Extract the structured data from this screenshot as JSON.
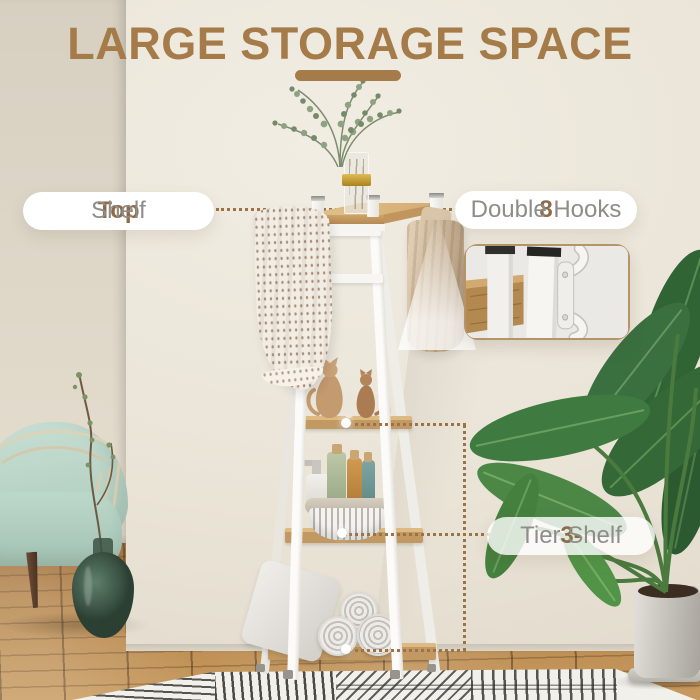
{
  "title": {
    "text": "LARGE STORAGE SPACE"
  },
  "callouts": {
    "top_shelf": {
      "bold": "Top",
      "rest": " Shelf"
    },
    "double_hooks": {
      "bold": "8",
      "rest": " Double Hooks"
    },
    "tier_shelf": {
      "bold": "3-",
      "rest": "Tier Shelf"
    }
  },
  "colors": {
    "accent": "#a57c49",
    "label_bold": "#8d6b46",
    "label_muted": "#8e8d8a",
    "dotted_line": "#9c7347",
    "pill_bg": "#ffffff",
    "shelf_wood": "#c49a63",
    "frame_white": "#f6f5f2",
    "chair_mint": "#b7d3c6",
    "leaf_green": "#3f7a40"
  }
}
